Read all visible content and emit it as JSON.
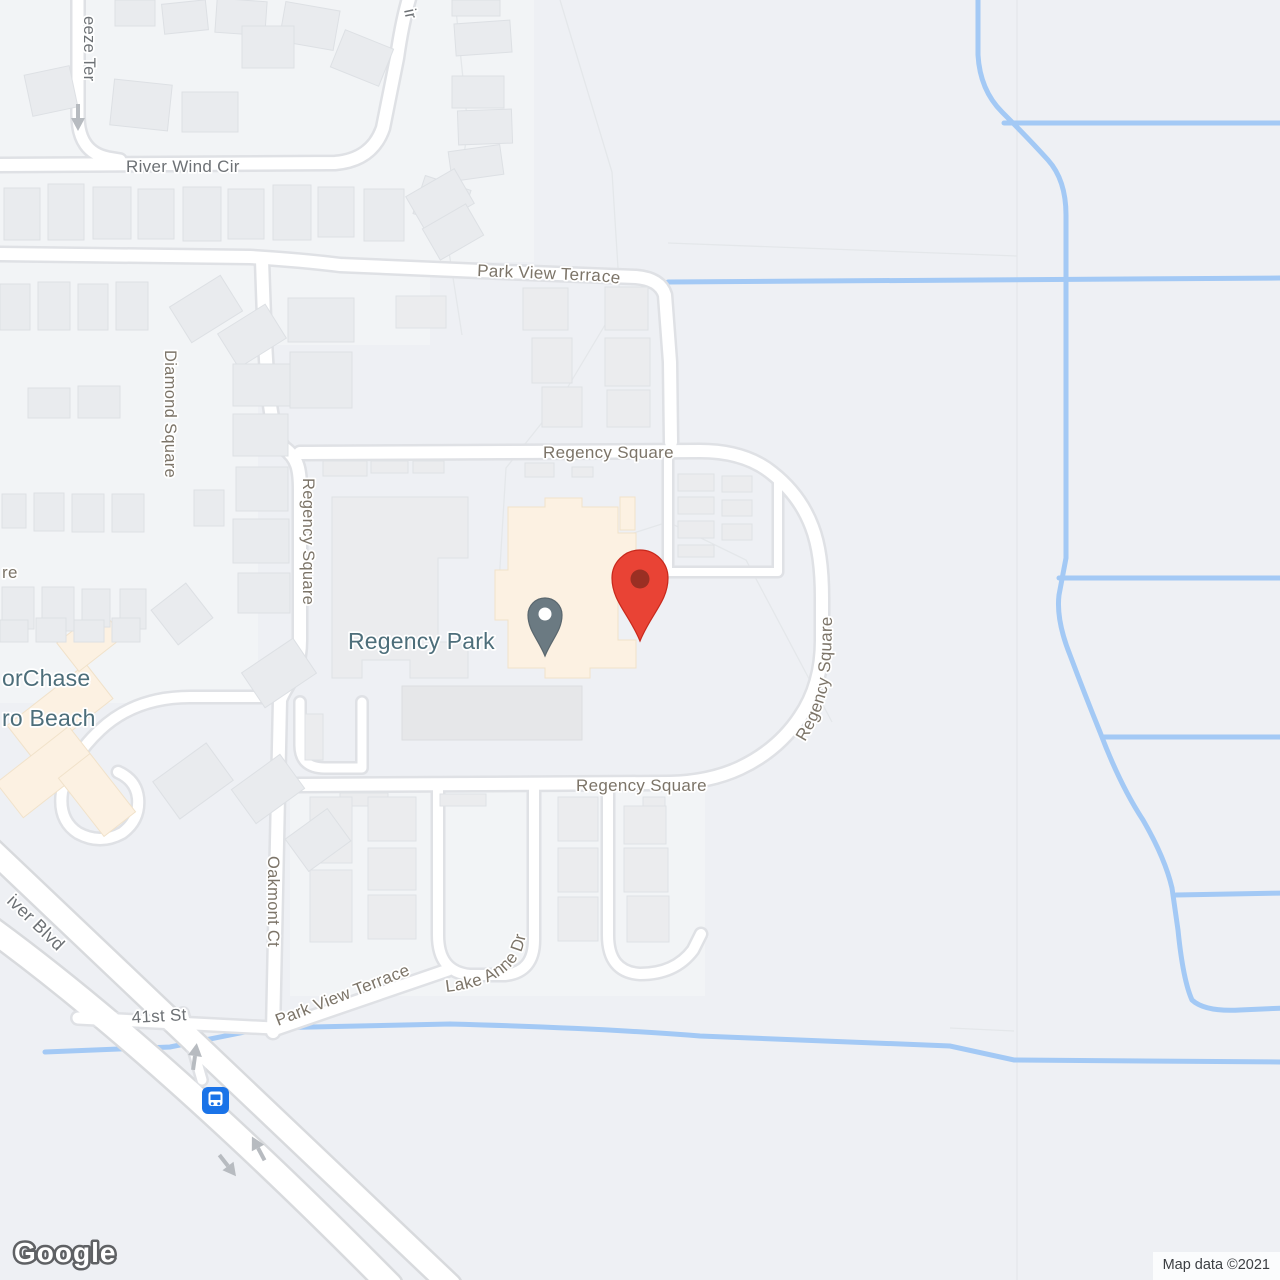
{
  "map": {
    "streets": {
      "breeze_ter_partial": "eeze Ter",
      "river_wind_cir": "River Wind Cir",
      "top_edge_partial": "ir",
      "park_view_terrace": "Park View Terrace",
      "regency_square": "Regency Square",
      "diamond_square": "Diamond Square",
      "left_edge_partial": "re",
      "oakmont_ct": "Oakmont Ct",
      "lake_anne_dr": "Lake Anne Dr",
      "forty_first_st": "41st St",
      "river_blvd_partial": "iver Blvd"
    },
    "poi": {
      "name": "Regency Park"
    },
    "clipped_place": {
      "line1": "orChase",
      "line2": "ro Beach"
    },
    "icons": {
      "destination": "red-map-pin",
      "poi_marker": "gray-map-pin",
      "transit": "bus-station-icon",
      "one_way": "one-way-arrow"
    }
  },
  "attribution": {
    "map_data": "Map data ©2021"
  },
  "logo": {
    "text": "Google"
  },
  "colors": {
    "water": "#A3C9F5",
    "pin_red": "#E94335",
    "pin_red_stroke": "#C8281B",
    "pin_red_inner": "#9A2F23",
    "poi_pin": "#6B7A82",
    "poi_pin_stroke": "#5A676E",
    "poi_text": "#4D6E7A",
    "bus_blue": "#1A73E8",
    "label_cool": "#6D7175",
    "label_warm": "#7C7468",
    "road_fill": "#FFFFFF",
    "road_casing": "#DFE1E5",
    "building": "#EBECEE",
    "cream_building": "#FCF1E2"
  }
}
